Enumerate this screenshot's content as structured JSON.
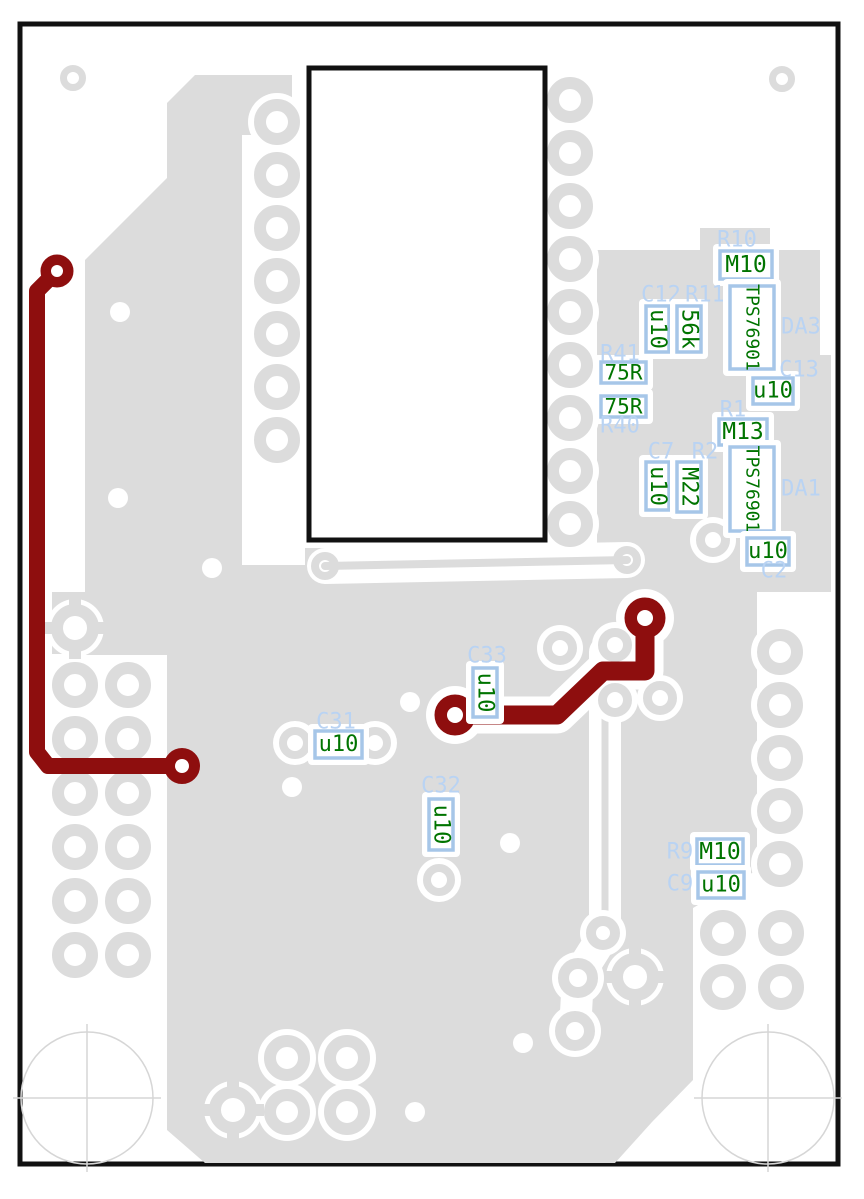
{
  "board": {
    "layer_colors": {
      "background": "#ffffff",
      "copper_pour": "#dcdcdc",
      "copper_trace_highlight": "#8e0e0e",
      "reference_text": "#b9d3f3",
      "value_text": "#007400",
      "pad_outline": "#a6c6e8",
      "board_outline": "#111111",
      "hole_marker": "#d6d6d6"
    }
  },
  "components": [
    {
      "ref": "R10",
      "value": "M10",
      "value_dir": "h",
      "ref_x": 737,
      "ref_y": 240,
      "box": [
        720,
        251,
        52,
        28
      ],
      "fs": 23
    },
    {
      "ref": "C12",
      "value": "u10",
      "value_dir": "v",
      "ref_x": 661,
      "ref_y": 295,
      "box": [
        646,
        306,
        23,
        46
      ],
      "fs": 22
    },
    {
      "ref": "R11",
      "value": "56k",
      "value_dir": "v",
      "ref_x": 705,
      "ref_y": 295,
      "box": [
        677,
        306,
        24,
        46
      ],
      "fs": 22
    },
    {
      "ref": "DA3",
      "value": "TPS76901",
      "value_dir": "v",
      "ref_x": 801,
      "ref_y": 327,
      "box": [
        730,
        286,
        44,
        83
      ],
      "fs": 18
    },
    {
      "ref": "C13",
      "value": "u10",
      "value_dir": "h",
      "ref_x": 799,
      "ref_y": 370,
      "box": [
        753,
        378,
        40,
        26
      ],
      "fs": 22
    },
    {
      "ref": "R41",
      "value": "75R",
      "value_dir": "h",
      "ref_x": 620,
      "ref_y": 354,
      "box": [
        601,
        362,
        45,
        21
      ],
      "fs": 21
    },
    {
      "ref": "R40",
      "value": "75R",
      "value_dir": "h",
      "ref_x": 620,
      "ref_y": 426,
      "box": [
        601,
        396,
        45,
        21
      ],
      "fs": 21
    },
    {
      "ref": "R1",
      "value": "M13",
      "value_dir": "h",
      "ref_x": 733,
      "ref_y": 410,
      "box": [
        719,
        419,
        48,
        26
      ],
      "fs": 23
    },
    {
      "ref": "C7",
      "value": "u10",
      "value_dir": "v",
      "ref_x": 661,
      "ref_y": 452,
      "box": [
        646,
        462,
        23,
        48
      ],
      "fs": 22
    },
    {
      "ref": "R2",
      "value": "M22",
      "value_dir": "v",
      "ref_x": 705,
      "ref_y": 452,
      "box": [
        677,
        462,
        24,
        50
      ],
      "fs": 22
    },
    {
      "ref": "DA1",
      "value": "TPS76901",
      "value_dir": "v",
      "ref_x": 801,
      "ref_y": 489,
      "box": [
        730,
        447,
        44,
        84
      ],
      "fs": 18
    },
    {
      "ref": "C2",
      "value": "u10",
      "value_dir": "h",
      "ref_x": 774,
      "ref_y": 571,
      "box": [
        747,
        538,
        42,
        27
      ],
      "fs": 22
    },
    {
      "ref": "C33",
      "value": "u10",
      "value_dir": "v",
      "ref_x": 487,
      "ref_y": 656,
      "box": [
        473,
        668,
        24,
        49
      ],
      "fs": 22
    },
    {
      "ref": "C31",
      "value": "u10",
      "value_dir": "h",
      "ref_x": 336,
      "ref_y": 722,
      "box": [
        315,
        731,
        47,
        27
      ],
      "fs": 22
    },
    {
      "ref": "C32",
      "value": "u10",
      "value_dir": "v",
      "ref_x": 441,
      "ref_y": 786,
      "box": [
        429,
        799,
        24,
        51
      ],
      "fs": 22
    },
    {
      "ref": "R9",
      "value": "M10",
      "value_dir": "h",
      "ref_x": 680,
      "ref_y": 852,
      "box": [
        697,
        839,
        46,
        26
      ],
      "fs": 23
    },
    {
      "ref": "C9",
      "value": "u10",
      "value_dir": "h",
      "ref_x": 680,
      "ref_y": 884,
      "box": [
        698,
        872,
        46,
        26
      ],
      "fs": 22
    }
  ]
}
